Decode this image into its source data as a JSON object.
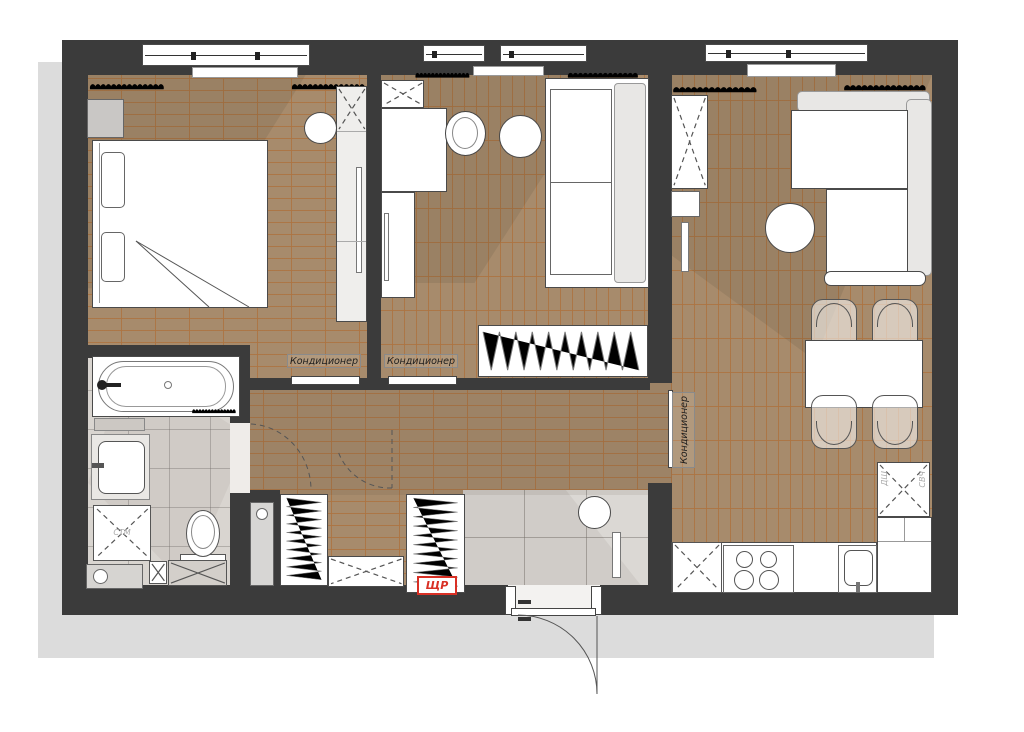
{
  "labels": {
    "air_conditioner": "Кондиционер",
    "electrical_panel": "ЩР",
    "oven_cabinet": "ДШ",
    "microwave": "СВЧ",
    "washing_machine": "СТМ"
  },
  "colors": {
    "wall": "#3b3b3b",
    "parquet": "#a78b6c",
    "parquet_joint": "#ad7340",
    "tile_entry": "#dbd8d4",
    "tile_bath": "#d9d5d0",
    "furniture_outline": "#4a4a4a",
    "accent_red": "#d93025",
    "drop_shadow": "#dcdcdc"
  }
}
